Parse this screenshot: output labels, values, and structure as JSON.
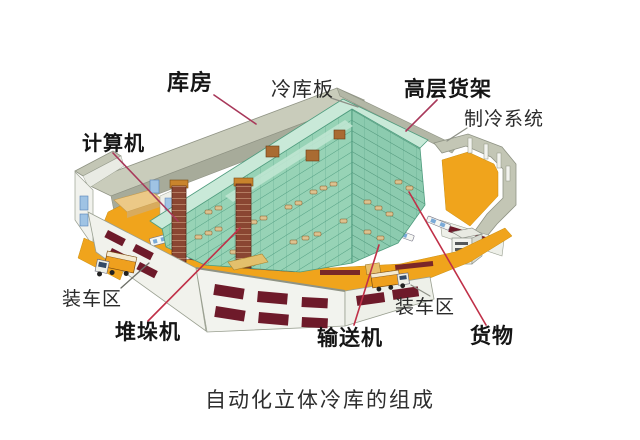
{
  "caption": "自动化立体冷库的组成",
  "labels": [
    {
      "id": "kufang",
      "text": "库房",
      "target": "roof-panel"
    },
    {
      "id": "lengkuban",
      "text": "冷库板",
      "target": "cold-storage-panel"
    },
    {
      "id": "gaocenghuojia",
      "text": "高层货架",
      "target": "high-rise-racks"
    },
    {
      "id": "zhilengxitong",
      "text": "制冷系统",
      "target": "refrigeration-system"
    },
    {
      "id": "jisuanji",
      "text": "计算机",
      "target": "computer-station"
    },
    {
      "id": "zhuangchequ_left",
      "text": "装车区",
      "target": "loading-area-left"
    },
    {
      "id": "duiduoji",
      "text": "堆垛机",
      "target": "stacker-crane"
    },
    {
      "id": "shusongji",
      "text": "输送机",
      "target": "conveyor"
    },
    {
      "id": "zhuangchequ_right",
      "text": "装车区",
      "target": "loading-area-right"
    },
    {
      "id": "huowu",
      "text": "货物",
      "target": "goods"
    }
  ],
  "colors": {
    "leader_red": "#b5304c",
    "leader_gray": "#8d9086",
    "floor_orange": "#f0a41c",
    "rack_green": "#97d3b6",
    "rack_green_top": "#c9e9d8",
    "roof_gray": "#c3c6b5",
    "dock_maroon": "#6e1a2a",
    "wall_white": "#f2f3ee",
    "window_blue": "#9fc3e4",
    "crane_brown": "#8a4632",
    "text_black": "#151515"
  }
}
